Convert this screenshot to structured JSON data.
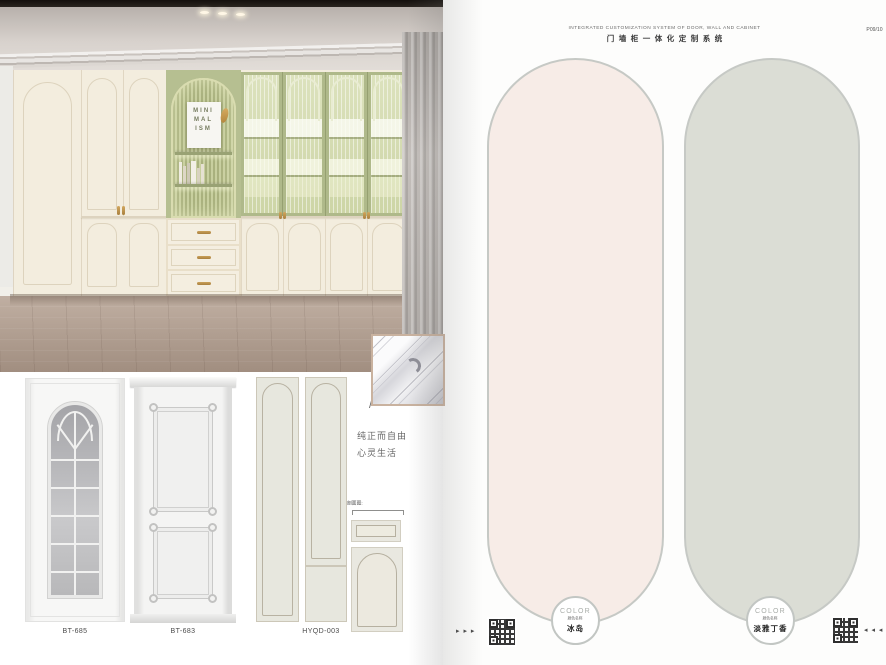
{
  "header": {
    "title_en": "INTEGRATED CUSTOMIZATION SYSTEM OF DOOR, WALL AND CABINET",
    "title_cn": "门墙柜一体化定制系统",
    "page_number": "P09/10"
  },
  "photo": {
    "poster": {
      "line1": "MINI",
      "line2": "MAL",
      "line3": "ISM"
    }
  },
  "samples": {
    "items": [
      {
        "code": "BT-685"
      },
      {
        "code": "BT-683"
      },
      {
        "code": "HYQD-003"
      }
    ],
    "section_label": "剖面图:"
  },
  "tagline": {
    "slash": "/",
    "line1": "纯正而自由",
    "line2": "心灵生活"
  },
  "swatches": {
    "left": {
      "badge": "COLOR",
      "name_label": "颜色名称",
      "name": "冰岛",
      "fill": "#f7ece7"
    },
    "right": {
      "badge": "COLOR",
      "name_label": "颜色名称",
      "name": "淡雅丁香",
      "fill": "#dbddd5"
    }
  },
  "nav": {
    "left_arrows": "▸ ▸ ▸",
    "right_arrows": "◂ ◂ ◂"
  },
  "colors": {
    "cream_cabinet": "#f3edde",
    "sage_green": "#afb98a",
    "gold_handle": "#b98e52",
    "swatch_border": "#c6c9c5",
    "floor_wood": "#b3a193"
  }
}
